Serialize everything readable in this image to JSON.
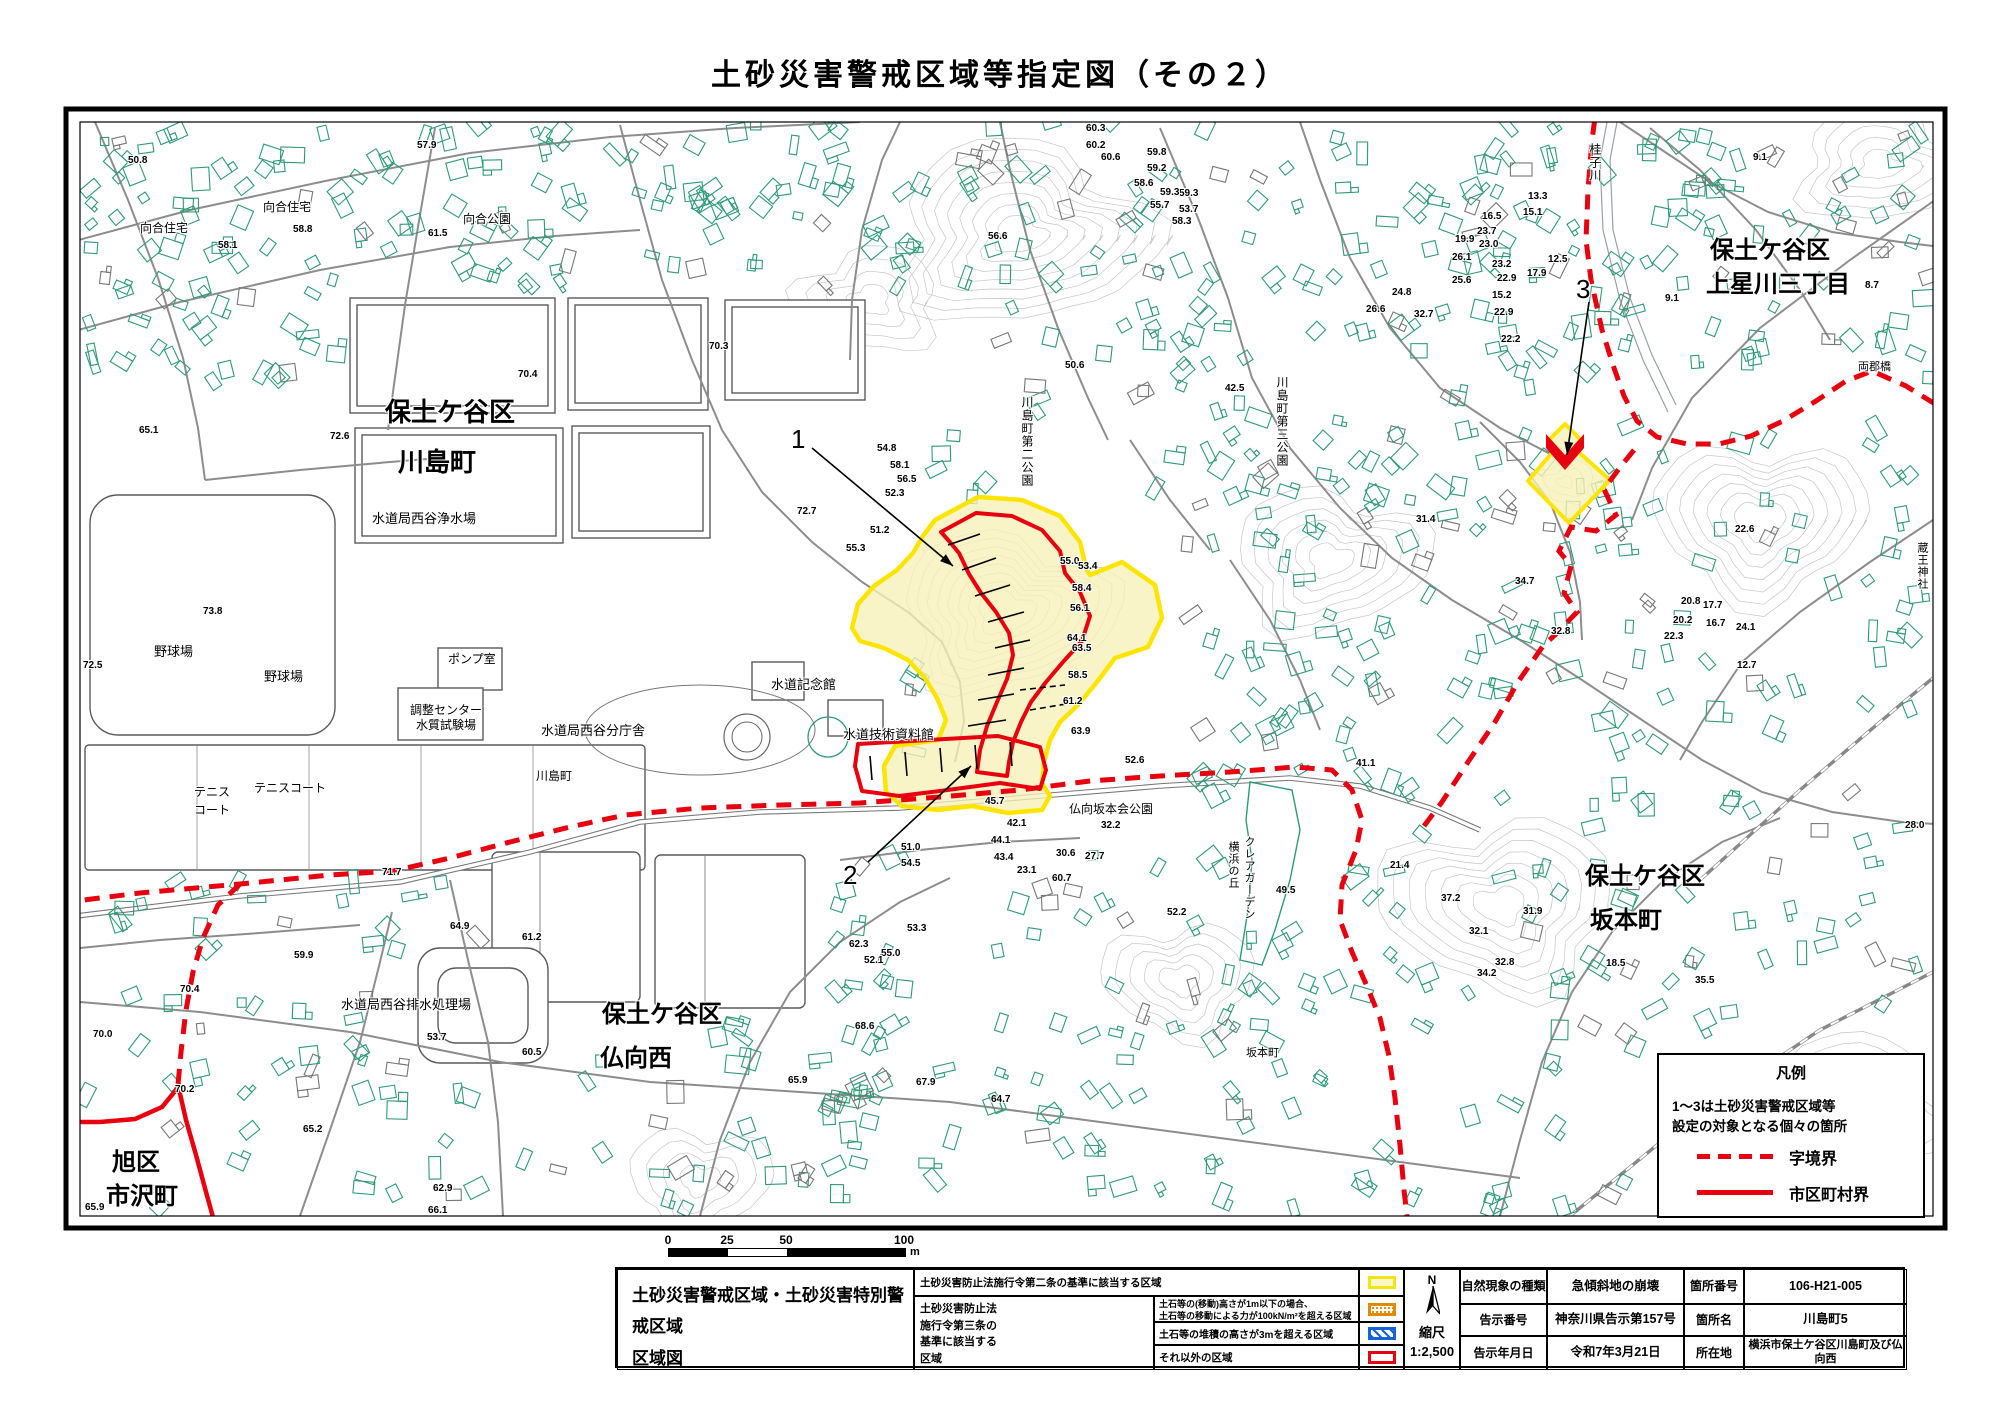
{
  "title": "土砂災害警戒区域等指定図（その２）",
  "map": {
    "area_labels": [
      {
        "t": "向合住宅",
        "x": 140,
        "y": 222,
        "s": 12
      },
      {
        "t": "向合住宅",
        "x": 263,
        "y": 201,
        "s": 12
      },
      {
        "t": "向合公園",
        "x": 463,
        "y": 213,
        "s": 12
      },
      {
        "t": "保土ケ谷区",
        "x": 385,
        "y": 398,
        "s": 26,
        "b": 1
      },
      {
        "t": "川島町",
        "x": 398,
        "y": 448,
        "s": 26,
        "b": 1
      },
      {
        "t": "水道局西谷浄水場",
        "x": 372,
        "y": 512,
        "s": 13
      },
      {
        "t": "野球場",
        "x": 154,
        "y": 645,
        "s": 13
      },
      {
        "t": "野球場",
        "x": 264,
        "y": 670,
        "s": 13
      },
      {
        "t": "ポンプ室",
        "x": 448,
        "y": 653,
        "s": 12
      },
      {
        "t": "調整センター",
        "x": 410,
        "y": 704,
        "s": 12
      },
      {
        "t": "水質試験場",
        "x": 416,
        "y": 719,
        "s": 12
      },
      {
        "t": "テニス",
        "x": 194,
        "y": 786,
        "s": 12
      },
      {
        "t": "コート",
        "x": 194,
        "y": 804,
        "s": 12
      },
      {
        "t": "テニスコート",
        "x": 254,
        "y": 782,
        "s": 12
      },
      {
        "t": "川島町",
        "x": 536,
        "y": 770,
        "s": 12
      },
      {
        "t": "水道記念館",
        "x": 771,
        "y": 678,
        "s": 13
      },
      {
        "t": "水道技術資料館",
        "x": 843,
        "y": 728,
        "s": 13
      },
      {
        "t": "水道局西谷分庁舎",
        "x": 541,
        "y": 724,
        "s": 13
      },
      {
        "t": "水道局西谷排水処理場",
        "x": 341,
        "y": 998,
        "s": 13
      },
      {
        "t": "保土ケ谷区",
        "x": 602,
        "y": 1002,
        "s": 24,
        "b": 1
      },
      {
        "t": "仏向西",
        "x": 600,
        "y": 1046,
        "s": 24,
        "b": 1
      },
      {
        "t": "旭区",
        "x": 112,
        "y": 1150,
        "s": 24,
        "b": 1
      },
      {
        "t": "市沢町",
        "x": 106,
        "y": 1184,
        "s": 24,
        "b": 1
      },
      {
        "t": "保土ケ谷区",
        "x": 1710,
        "y": 238,
        "s": 24,
        "b": 1
      },
      {
        "t": "上星川三丁目",
        "x": 1706,
        "y": 272,
        "s": 24,
        "b": 1
      },
      {
        "t": "保土ケ谷区",
        "x": 1585,
        "y": 864,
        "s": 24,
        "b": 1
      },
      {
        "t": "坂本町",
        "x": 1590,
        "y": 908,
        "s": 24,
        "b": 1
      },
      {
        "t": "仏向坂本会公園",
        "x": 1069,
        "y": 803,
        "s": 12
      },
      {
        "t": "坂本町",
        "x": 1246,
        "y": 1048,
        "s": 11
      },
      {
        "t": "両郡橋",
        "x": 1858,
        "y": 362,
        "s": 11
      },
      {
        "t": "川島町第二公園",
        "x": 1021,
        "y": 396,
        "s": 12,
        "v": 1
      },
      {
        "t": "川島町第三公園",
        "x": 1276,
        "y": 376,
        "s": 12,
        "v": 1
      },
      {
        "t": "桂子川",
        "x": 1589,
        "y": 143,
        "s": 12,
        "v": 1
      },
      {
        "t": "クレアガーデン",
        "x": 1243,
        "y": 836,
        "s": 11,
        "v": 1
      },
      {
        "t": "横浜の丘",
        "x": 1227,
        "y": 841,
        "s": 11,
        "v": 1
      },
      {
        "t": "蔵王神社",
        "x": 1916,
        "y": 542,
        "s": 11,
        "v": 1
      }
    ],
    "spot_elevations": [
      [
        "50.8",
        128,
        155
      ],
      [
        "57.9",
        417,
        140
      ],
      [
        "58.8",
        293,
        224
      ],
      [
        "58.1",
        218,
        240
      ],
      [
        "61.5",
        428,
        228
      ],
      [
        "65.1",
        139,
        425
      ],
      [
        "72.6",
        330,
        431
      ],
      [
        "70.3",
        709,
        341
      ],
      [
        "70.4",
        518,
        369
      ],
      [
        "56.6",
        988,
        231
      ],
      [
        "60.3",
        1086,
        123
      ],
      [
        "60.2",
        1086,
        140
      ],
      [
        "60.6",
        1101,
        152
      ],
      [
        "59.8",
        1147,
        147
      ],
      [
        "59.2",
        1147,
        163
      ],
      [
        "58.6",
        1134,
        178
      ],
      [
        "59.3",
        1179,
        188
      ],
      [
        "53.7",
        1179,
        204
      ],
      [
        "50.6",
        1065,
        360
      ],
      [
        "59.3",
        1160,
        187
      ],
      [
        "55.7",
        1150,
        200
      ],
      [
        "58.3",
        1172,
        216
      ],
      [
        "73.8",
        203,
        606
      ],
      [
        "72.5",
        83,
        660
      ],
      [
        "72.7",
        797,
        506
      ],
      [
        "55.0",
        1060,
        556
      ],
      [
        "53.4",
        1078,
        561
      ],
      [
        "58.4",
        1072,
        583
      ],
      [
        "56.1",
        1070,
        603
      ],
      [
        "64.1",
        1067,
        633
      ],
      [
        "63.5",
        1072,
        643
      ],
      [
        "58.5",
        1068,
        670
      ],
      [
        "61.2",
        1063,
        696
      ],
      [
        "63.9",
        1071,
        726
      ],
      [
        "54.8",
        877,
        443
      ],
      [
        "58.1",
        890,
        460
      ],
      [
        "56.5",
        897,
        474
      ],
      [
        "52.3",
        885,
        488
      ],
      [
        "51.2",
        870,
        525
      ],
      [
        "55.3",
        846,
        543
      ],
      [
        "42.5",
        1225,
        383
      ],
      [
        "31.4",
        1416,
        514
      ],
      [
        "34.7",
        1515,
        576
      ],
      [
        "32.8",
        1551,
        626
      ],
      [
        "22.6",
        1735,
        524
      ],
      [
        "13.3",
        1528,
        191
      ],
      [
        "15.1",
        1523,
        207
      ],
      [
        "16.5",
        1482,
        211
      ],
      [
        "23.7",
        1477,
        226
      ],
      [
        "19.9",
        1455,
        234
      ],
      [
        "23.0",
        1479,
        239
      ],
      [
        "26.1",
        1452,
        252
      ],
      [
        "23.2",
        1492,
        259
      ],
      [
        "12.5",
        1548,
        254
      ],
      [
        "17.9",
        1527,
        268
      ],
      [
        "25.6",
        1452,
        275
      ],
      [
        "22.9",
        1497,
        273
      ],
      [
        "24.8",
        1392,
        287
      ],
      [
        "15.2",
        1492,
        290
      ],
      [
        "26.6",
        1366,
        304
      ],
      [
        "32.7",
        1414,
        309
      ],
      [
        "22.9",
        1494,
        307
      ],
      [
        "22.2",
        1501,
        334
      ],
      [
        "9.1",
        1753,
        152
      ],
      [
        "9.1",
        1665,
        293
      ],
      [
        "8.7",
        1865,
        280
      ],
      [
        "71.7",
        382,
        867
      ],
      [
        "70.4",
        180,
        984
      ],
      [
        "70.0",
        93,
        1029
      ],
      [
        "59.9",
        294,
        950
      ],
      [
        "64.9",
        450,
        921
      ],
      [
        "61.2",
        522,
        932
      ],
      [
        "53.7",
        427,
        1032
      ],
      [
        "60.5",
        522,
        1047
      ],
      [
        "70.2",
        175,
        1084
      ],
      [
        "65.2",
        303,
        1124
      ],
      [
        "65.9",
        85,
        1202
      ],
      [
        "62.9",
        433,
        1183
      ],
      [
        "66.1",
        428,
        1205
      ],
      [
        "68.6",
        855,
        1021
      ],
      [
        "65.9",
        788,
        1075
      ],
      [
        "67.9",
        916,
        1077
      ],
      [
        "64.7",
        991,
        1094
      ],
      [
        "52.6",
        1125,
        755
      ],
      [
        "41.1",
        1356,
        758
      ],
      [
        "60.7",
        1052,
        873
      ],
      [
        "52.2",
        1167,
        907
      ],
      [
        "49.5",
        1276,
        885
      ],
      [
        "37.2",
        1441,
        893
      ],
      [
        "31.9",
        1523,
        906
      ],
      [
        "32.1",
        1469,
        926
      ],
      [
        "32.8",
        1495,
        957
      ],
      [
        "34.2",
        1477,
        968
      ],
      [
        "18.5",
        1606,
        958
      ],
      [
        "35.5",
        1695,
        975
      ],
      [
        "20.8",
        1681,
        596
      ],
      [
        "17.7",
        1703,
        600
      ],
      [
        "20.2",
        1673,
        615
      ],
      [
        "16.7",
        1706,
        618
      ],
      [
        "22.3",
        1664,
        631
      ],
      [
        "24.1",
        1736,
        622
      ],
      [
        "12.7",
        1737,
        660
      ],
      [
        "28.0",
        1905,
        820
      ],
      [
        "45.7",
        985,
        796
      ],
      [
        "42.1",
        1007,
        818
      ],
      [
        "44.1",
        991,
        835
      ],
      [
        "51.0",
        901,
        842
      ],
      [
        "54.5",
        901,
        858
      ],
      [
        "43.4",
        994,
        852
      ],
      [
        "32.2",
        1101,
        820
      ],
      [
        "30.6",
        1056,
        848
      ],
      [
        "27.7",
        1085,
        851
      ],
      [
        "23.1",
        1017,
        865
      ],
      [
        "21.4",
        1390,
        860
      ],
      [
        "53.3",
        907,
        923
      ],
      [
        "55.0",
        881,
        948
      ],
      [
        "62.3",
        849,
        939
      ],
      [
        "52.1",
        864,
        955
      ]
    ],
    "markers": [
      {
        "n": "1",
        "tx": 791,
        "ty": 424,
        "x1": 812,
        "y1": 448,
        "x2": 953,
        "y2": 566
      },
      {
        "n": "2",
        "tx": 843,
        "ty": 860,
        "x1": 868,
        "y1": 862,
        "x2": 971,
        "y2": 766
      },
      {
        "n": "3",
        "tx": 1576,
        "ty": 274,
        "x1": 1589,
        "y1": 302,
        "x2": 1567,
        "y2": 455
      }
    ],
    "colors": {
      "building_outline": "#2e9b77",
      "road": "#8d8d8d",
      "contour": "#c6c6c6",
      "boundary_red": "#e8000f",
      "zone_yellow_stroke": "#ffe400",
      "zone_yellow_fill": "#f6f1b8"
    }
  },
  "legend": {
    "title": "凡例",
    "note_line1": "1〜3は土砂災害警戒区域等",
    "note_line2": "設定の対象となる個々の箇所",
    "dashed_label": "字境界",
    "solid_label": "市区町村界"
  },
  "scale_bar": {
    "ticks": [
      "0",
      "25",
      "50",
      "100"
    ],
    "unit": "m"
  },
  "sheet": {
    "doc_title_line1": "土砂災害警戒区域・土砂災害特別警戒区域",
    "doc_title_line2": "区域図",
    "law2_text": "土砂災害防止法施行令第二条の基準に該当する区域",
    "law3_label_lines": [
      "土砂災害防止法",
      "施行令第三条の",
      "基準に該当する",
      "区域"
    ],
    "law3_row1_line1": "土石等の(移動)高さが1m以下の場合、",
    "law3_row1_line2": "土石等の移動による力が100kN/m²を超える区域",
    "law3_row2": "土石等の堆積の高さが3mを超える区域",
    "law3_row3": "それ以外の区域",
    "compass_label": "N",
    "scale_label": "縮尺",
    "scale_value": "1:2,500",
    "info": [
      [
        "自然現象の種類",
        "急傾斜地の崩壊",
        "箇所番号",
        "106-H21-005"
      ],
      [
        "告示番号",
        "神奈川県告示第157号",
        "箇所名",
        "川島町5"
      ],
      [
        "告示年月日",
        "令和7年3月21日",
        "所在地",
        "横浜市保土ケ谷区川島町及び仏向西"
      ]
    ]
  }
}
